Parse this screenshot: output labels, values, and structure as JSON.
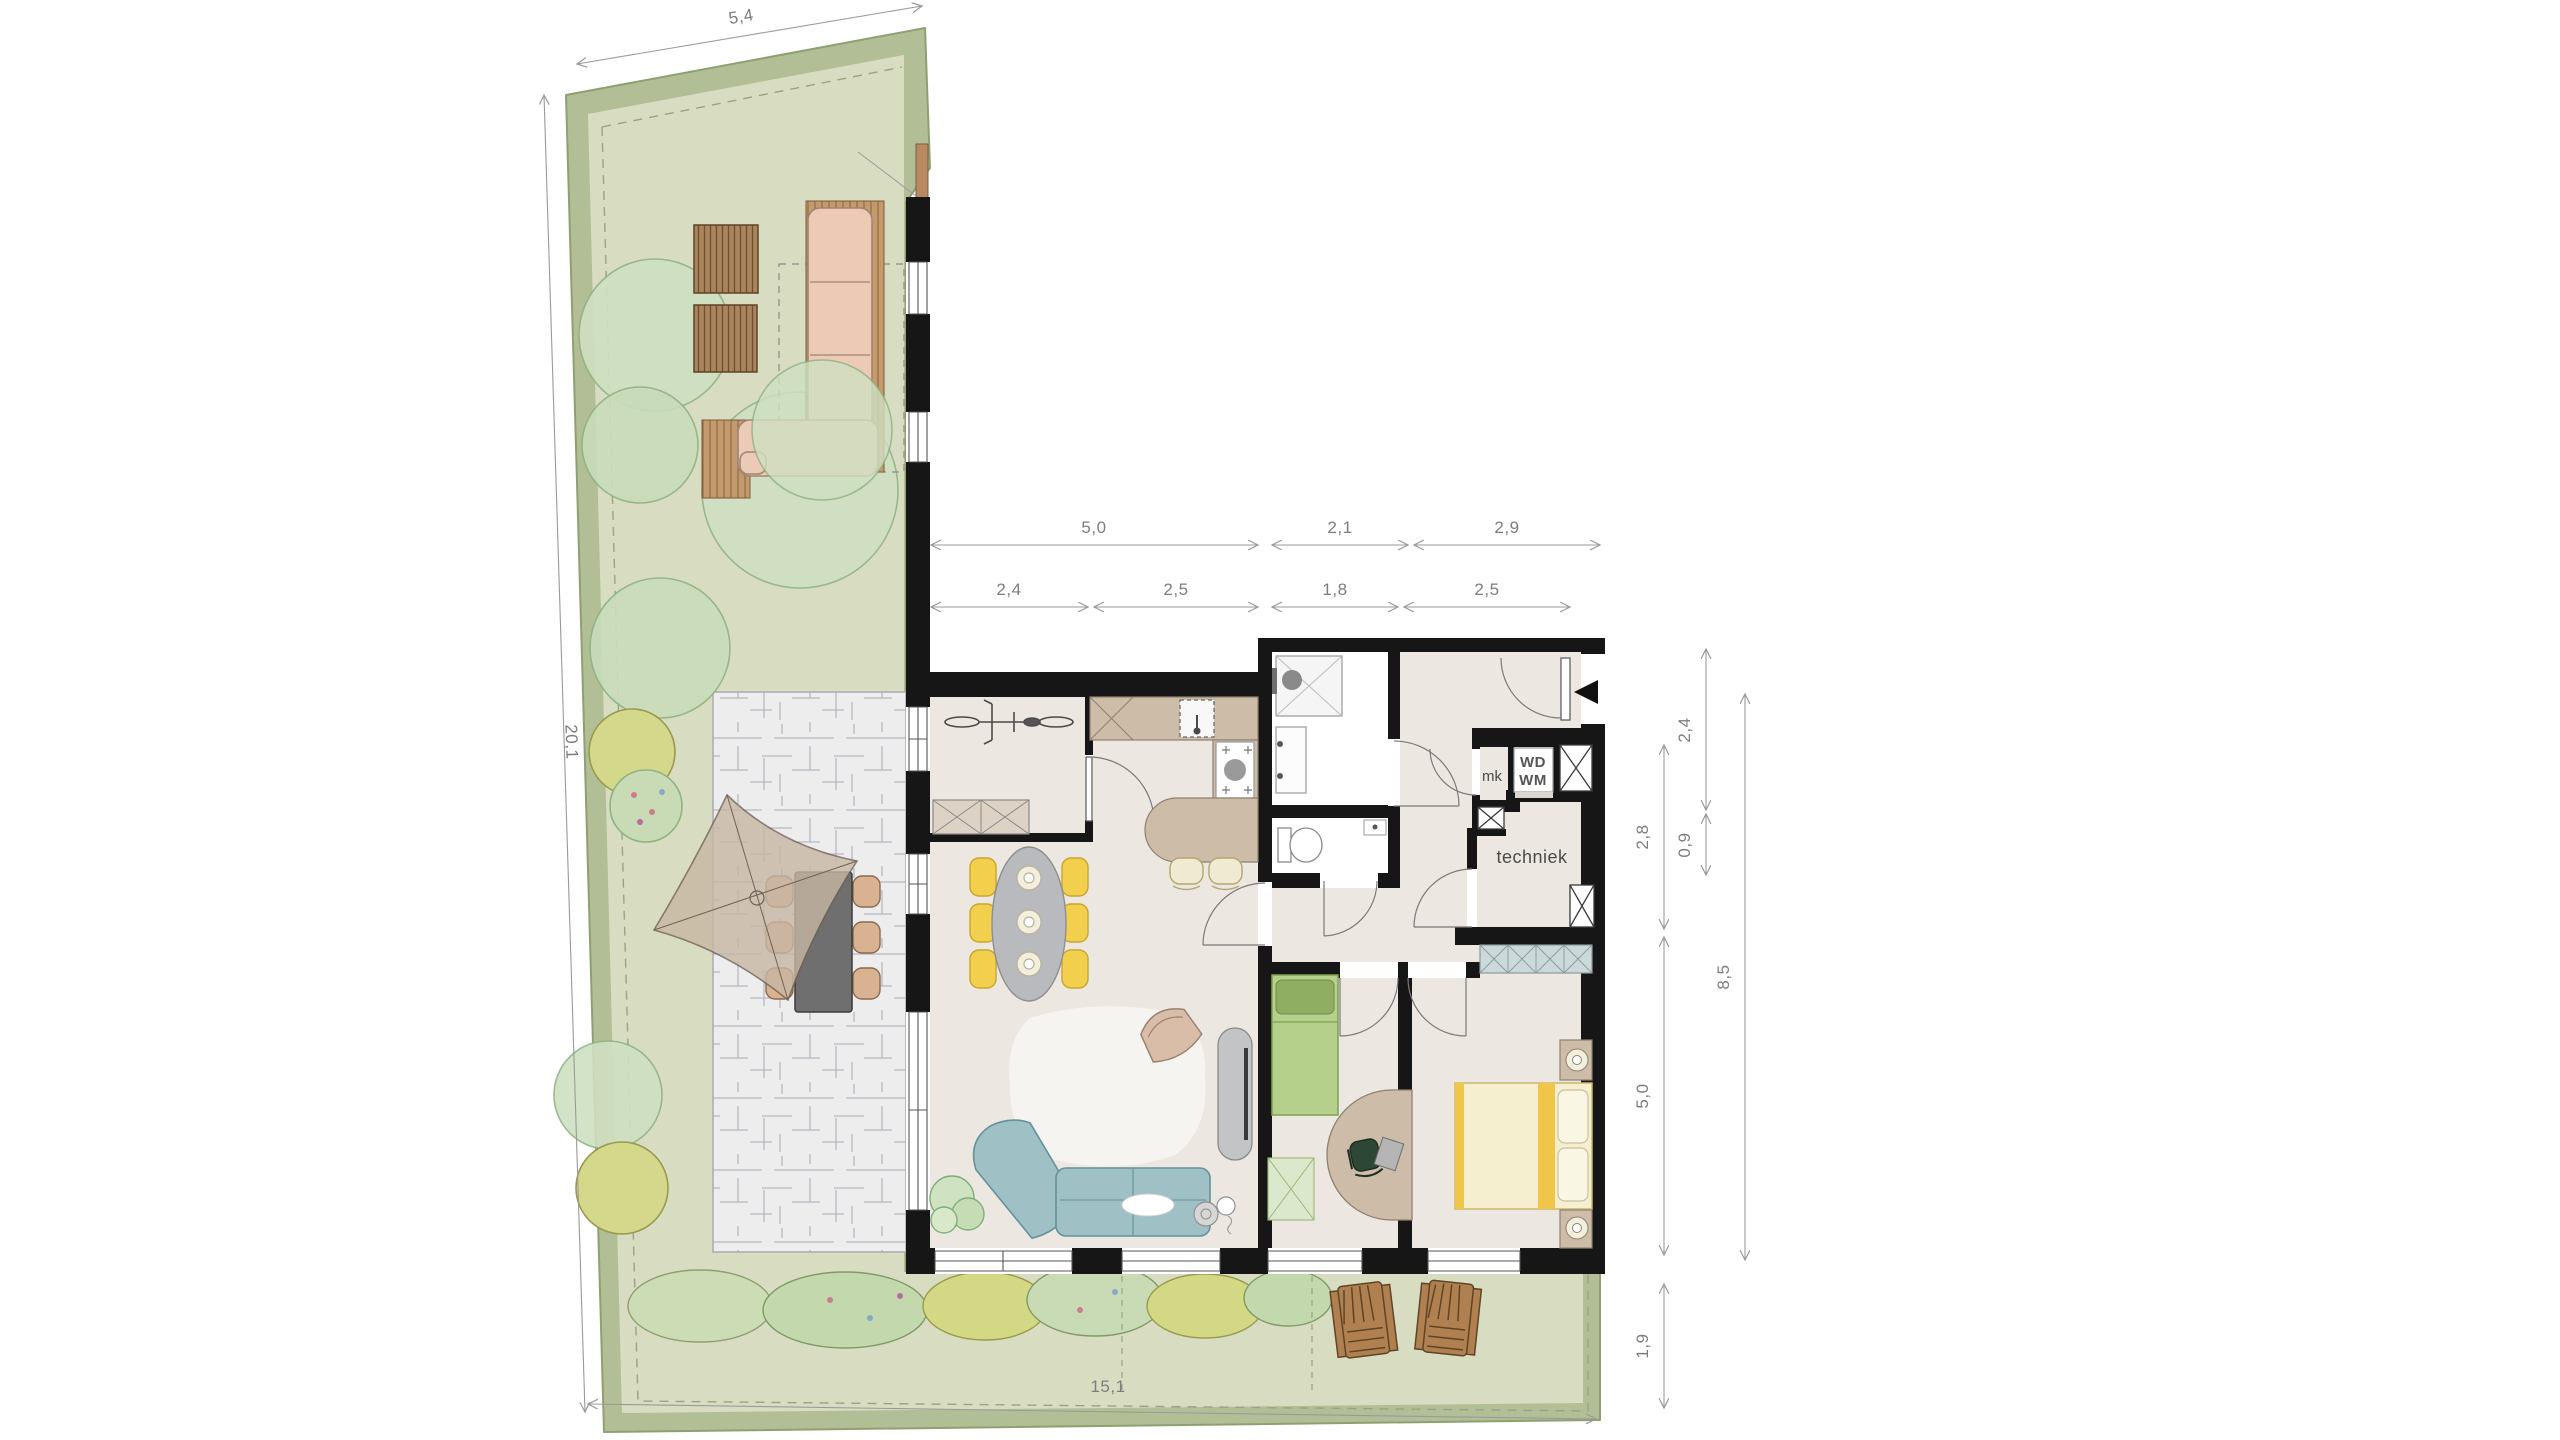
{
  "plan": {
    "type": "residential floor plan with garden (site plan)",
    "room_labels": {
      "techniek": "techniek",
      "meter_closet": "mk"
    },
    "appliances": {
      "wd": "WD",
      "wm": "WM"
    },
    "dimensions": {
      "site_top": "5,4",
      "site_left": "20,1",
      "site_bottom": "15,1",
      "top_outer": [
        "5,0",
        "2,1",
        "2,9"
      ],
      "top_inner": [
        "2,4",
        "2,5",
        "1,8",
        "2,5"
      ],
      "right_inner": [
        "2,8",
        "5,0",
        "1,9"
      ],
      "right_mid": [
        "2,4",
        "0,9"
      ],
      "right_overall": "8,5"
    },
    "colors": {
      "hedge": "#b2bf96",
      "lawn": "#d8ddc2",
      "pavement": "#ededee",
      "wall": "#161616",
      "floor": "#ece7e1",
      "counter_wood": "#cdbca8",
      "outdoor_wood": "#c49a6c",
      "sofa_teal": "#9fc0c4",
      "chair_yellow": "#f3cf4e",
      "master_bed_yellow": "#f0c64a",
      "kids_bed_green": "#b5d08a",
      "closet_blue": "#ccd9da",
      "lounge_pink": "#eccab6",
      "sail_tan": "#c7b7a4",
      "tree_green": "#cfe0c2",
      "dim_grey": "#8a8a8a"
    }
  }
}
